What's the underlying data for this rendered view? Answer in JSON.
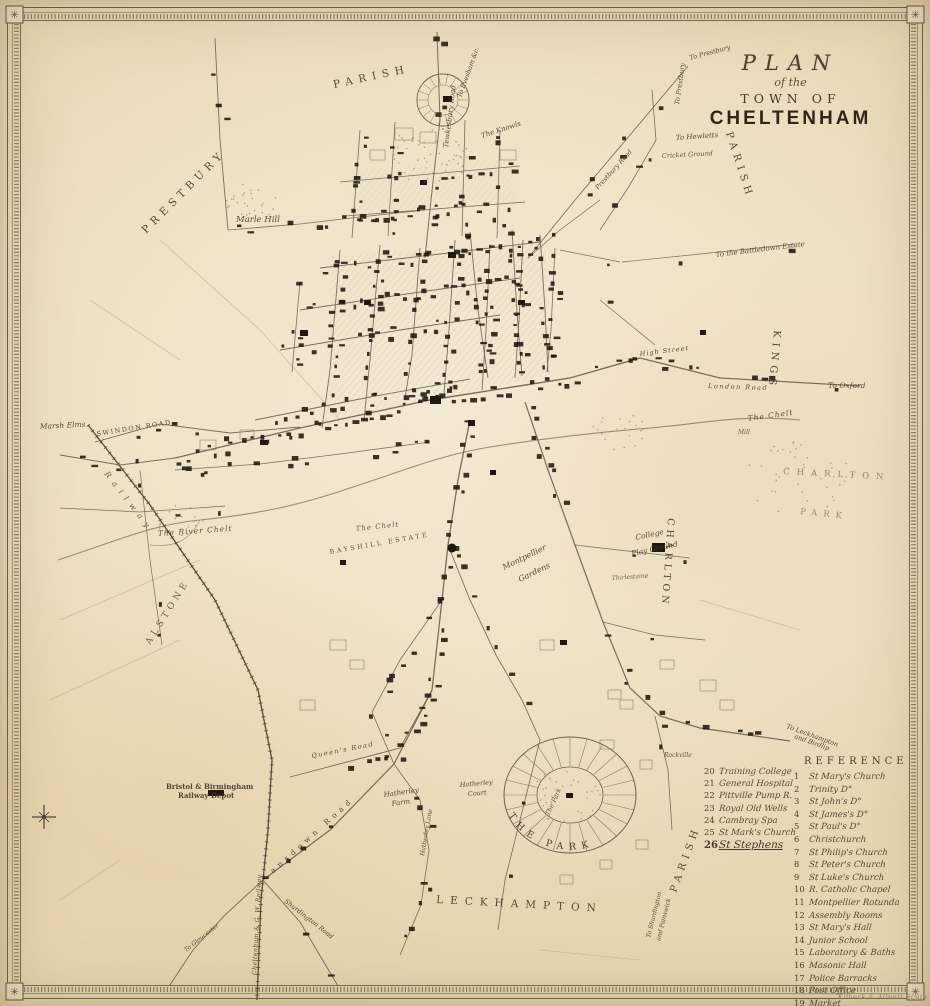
{
  "title": {
    "line1": "PLAN",
    "line2": "of the",
    "line3": "TOWN OF",
    "line4": "CHELTENHAM"
  },
  "legend_left": {
    "items": [
      {
        "num": "20",
        "label": "Training College"
      },
      {
        "num": "21",
        "label": "General Hospital"
      },
      {
        "num": "22",
        "label": "Pittville Pump R."
      },
      {
        "num": "23",
        "label": "Royal Old Wells"
      },
      {
        "num": "24",
        "label": "Cambray Spa"
      },
      {
        "num": "25",
        "label": "St Mark's Church"
      },
      {
        "num": "26",
        "label": "St Stephens",
        "emph": true
      }
    ]
  },
  "legend_right": {
    "header": "REFERENCE",
    "items": [
      {
        "num": "1",
        "label": "St Mary's Church"
      },
      {
        "num": "2",
        "label": "Trinity D°"
      },
      {
        "num": "3",
        "label": "St John's D°"
      },
      {
        "num": "4",
        "label": "St James's D°"
      },
      {
        "num": "5",
        "label": "St Paul's D°"
      },
      {
        "num": "6",
        "label": "Christchurch"
      },
      {
        "num": "7",
        "label": "St Philip's Church"
      },
      {
        "num": "8",
        "label": "St Peter's Church"
      },
      {
        "num": "9",
        "label": "St Luke's Church"
      },
      {
        "num": "10",
        "label": "R. Catholic Chapel"
      },
      {
        "num": "11",
        "label": "Montpellier Rotunda"
      },
      {
        "num": "12",
        "label": "Assembly Rooms"
      },
      {
        "num": "13",
        "label": "St Mary's Hall"
      },
      {
        "num": "14",
        "label": "Junior School"
      },
      {
        "num": "15",
        "label": "Laboratory & Baths"
      },
      {
        "num": "16",
        "label": "Masonic Hall"
      },
      {
        "num": "17",
        "label": "Police Barracks"
      },
      {
        "num": "18",
        "label": "Post Office"
      },
      {
        "num": "19",
        "label": "Market"
      }
    ]
  },
  "park_label": "THE PARK",
  "signature": "Kilbeck & Allnutt Sculp.",
  "colors": {
    "ink": "#4a4133",
    "road": "#6b6152",
    "building": "#1d1810",
    "river": "#8a7c63",
    "parchment": "#eee2c6"
  },
  "map_labels": [
    {
      "t": "PRESTBURY",
      "x": 146,
      "y": 234,
      "r": -45,
      "s": 10.5,
      "sp": 5
    },
    {
      "t": "PARISH",
      "x": 334,
      "y": 88,
      "r": -12,
      "s": 10.5,
      "sp": 6
    },
    {
      "t": "PARISH",
      "x": 726,
      "y": 133,
      "r": 72,
      "s": 10,
      "sp": 5
    },
    {
      "t": "KINGS",
      "x": 774,
      "y": 330,
      "r": 95,
      "s": 10,
      "sp": 5
    },
    {
      "t": "CHARLTON",
      "x": 668,
      "y": 518,
      "r": 94,
      "s": 9.5,
      "sp": 4
    },
    {
      "t": "CHARLTON",
      "x": 783,
      "y": 474,
      "r": 3,
      "s": 8.5,
      "sp": 7,
      "o": 0.55
    },
    {
      "t": "PARK",
      "x": 800,
      "y": 514,
      "r": 6,
      "s": 8.5,
      "sp": 6,
      "o": 0.5
    },
    {
      "t": "LECKHAMPTON",
      "x": 436,
      "y": 903,
      "r": 3,
      "s": 10.5,
      "sp": 7
    },
    {
      "t": "PARISH",
      "x": 676,
      "y": 893,
      "r": -70,
      "s": 10,
      "sp": 5
    },
    {
      "t": "ALSTONE",
      "x": 150,
      "y": 645,
      "r": -58,
      "s": 9,
      "sp": 4,
      "o": 0.8
    },
    {
      "t": "Railway",
      "x": 104,
      "y": 474,
      "r": 52,
      "s": 8,
      "sp": 6,
      "st": "i",
      "o": 0.8
    },
    {
      "t": "Marle Hill",
      "x": 236,
      "y": 222,
      "s": 8.5,
      "st": "i"
    },
    {
      "t": "Marsh Elms",
      "x": 40,
      "y": 429,
      "r": -3,
      "s": 7.5,
      "st": "i"
    },
    {
      "t": "SWINDON ROAD",
      "x": 97,
      "y": 436,
      "r": -9,
      "s": 6.5,
      "sp": 1.5
    },
    {
      "t": "Tewkesbury Road",
      "x": 448,
      "y": 148,
      "r": -83,
      "s": 7,
      "st": "i"
    },
    {
      "t": "To Evesham &c.",
      "x": 461,
      "y": 98,
      "r": -70,
      "s": 6.5,
      "st": "i"
    },
    {
      "t": "To Prestbury",
      "x": 690,
      "y": 60,
      "r": -15,
      "s": 6.5,
      "st": "i"
    },
    {
      "t": "To Prestbury",
      "x": 679,
      "y": 105,
      "r": -82,
      "s": 6.5,
      "st": "i"
    },
    {
      "t": "To Hewletts",
      "x": 676,
      "y": 140,
      "r": -4,
      "s": 7,
      "st": "i"
    },
    {
      "t": "Cricket Ground",
      "x": 662,
      "y": 158,
      "r": -3,
      "s": 6.5,
      "st": "i",
      "o": 0.85
    },
    {
      "t": "To the Battledown Estate",
      "x": 716,
      "y": 257,
      "r": -7,
      "s": 7,
      "st": "i"
    },
    {
      "t": "To Oxford",
      "x": 828,
      "y": 388,
      "s": 7.5,
      "st": "i"
    },
    {
      "t": "London Road",
      "x": 708,
      "y": 388,
      "r": 2,
      "s": 6.5,
      "sp": 1.5,
      "st": "i"
    },
    {
      "t": "High Street",
      "x": 640,
      "y": 356,
      "r": -7,
      "s": 6.5,
      "sp": 1,
      "st": "i"
    },
    {
      "t": "The Chelt",
      "x": 748,
      "y": 421,
      "r": -8,
      "s": 7.5,
      "sp": 1,
      "st": "i"
    },
    {
      "t": "The River Chelt",
      "x": 158,
      "y": 536,
      "r": -4,
      "s": 7.5,
      "sp": 1,
      "st": "i"
    },
    {
      "t": "The Chelt",
      "x": 356,
      "y": 531,
      "r": -6,
      "s": 7,
      "sp": 1,
      "st": "i",
      "o": 0.85
    },
    {
      "t": "BAYSHILL ESTATE",
      "x": 330,
      "y": 554,
      "r": -10,
      "s": 6.5,
      "sp": 2.5,
      "o": 0.85
    },
    {
      "t": "Montpellier",
      "x": 504,
      "y": 570,
      "r": -26,
      "s": 8,
      "st": "i"
    },
    {
      "t": "Gardens",
      "x": 520,
      "y": 582,
      "r": -26,
      "s": 8,
      "st": "i"
    },
    {
      "t": "College",
      "x": 636,
      "y": 540,
      "r": -12,
      "s": 7.5,
      "st": "i"
    },
    {
      "t": "Play Ground",
      "x": 632,
      "y": 556,
      "r": -12,
      "s": 7.5,
      "st": "i"
    },
    {
      "t": "Thirlestaine",
      "x": 612,
      "y": 580,
      "r": -4,
      "s": 6,
      "st": "i",
      "o": 0.8
    },
    {
      "t": "The Park",
      "x": 549,
      "y": 816,
      "r": -65,
      "s": 6.5,
      "st": "i",
      "o": 0.85
    },
    {
      "t": "Hatherley",
      "x": 384,
      "y": 797,
      "r": -8,
      "s": 7,
      "st": "i"
    },
    {
      "t": "Farm",
      "x": 392,
      "y": 806,
      "r": -8,
      "s": 7,
      "st": "i"
    },
    {
      "t": "Hatherley",
      "x": 460,
      "y": 787,
      "r": -5,
      "s": 6.5,
      "st": "i"
    },
    {
      "t": "Court",
      "x": 468,
      "y": 796,
      "r": -5,
      "s": 6.5,
      "st": "i"
    },
    {
      "t": "Hatherley Lane",
      "x": 424,
      "y": 856,
      "r": -80,
      "s": 6,
      "st": "i"
    },
    {
      "t": "Bristol & Birmingham",
      "x": 166,
      "y": 789,
      "s": 7,
      "st": "b"
    },
    {
      "t": "Railway Depot",
      "x": 178,
      "y": 798,
      "s": 7,
      "st": "b"
    },
    {
      "t": "Queen's Road",
      "x": 312,
      "y": 758,
      "r": -11,
      "s": 6.5,
      "sp": 1.5,
      "st": "i"
    },
    {
      "t": "Lansdown Road",
      "x": 266,
      "y": 880,
      "r": -42,
      "s": 7.5,
      "sp": 4.5
    },
    {
      "t": "Cheltenham & G. W. Railway",
      "x": 256,
      "y": 975,
      "r": -87,
      "s": 6,
      "sp": 0.5,
      "st": "i"
    },
    {
      "t": "To Gloucester",
      "x": 186,
      "y": 952,
      "r": -38,
      "s": 6,
      "st": "i"
    },
    {
      "t": "To Shurdington",
      "x": 650,
      "y": 938,
      "r": -76,
      "s": 6,
      "st": "i"
    },
    {
      "t": "and Painswick",
      "x": 660,
      "y": 941,
      "r": -76,
      "s": 6,
      "st": "i"
    },
    {
      "t": "To Leckhampton",
      "x": 786,
      "y": 728,
      "r": 20,
      "s": 6.5,
      "st": "i"
    },
    {
      "t": "and Birdlip",
      "x": 794,
      "y": 738,
      "r": 20,
      "s": 6.5,
      "st": "i"
    },
    {
      "t": "Rockville",
      "x": 664,
      "y": 757,
      "s": 6,
      "st": "i",
      "o": 0.85
    },
    {
      "t": "Mill",
      "x": 738,
      "y": 434,
      "s": 6,
      "st": "i",
      "o": 0.8
    },
    {
      "t": "The Knowls",
      "x": 482,
      "y": 138,
      "r": -18,
      "s": 7,
      "st": "i"
    },
    {
      "t": "Prestbury Road",
      "x": 598,
      "y": 190,
      "r": -48,
      "s": 6.5,
      "st": "i"
    },
    {
      "t": "Shurdington Road",
      "x": 284,
      "y": 902,
      "r": 38,
      "s": 6.5,
      "st": "i"
    }
  ]
}
